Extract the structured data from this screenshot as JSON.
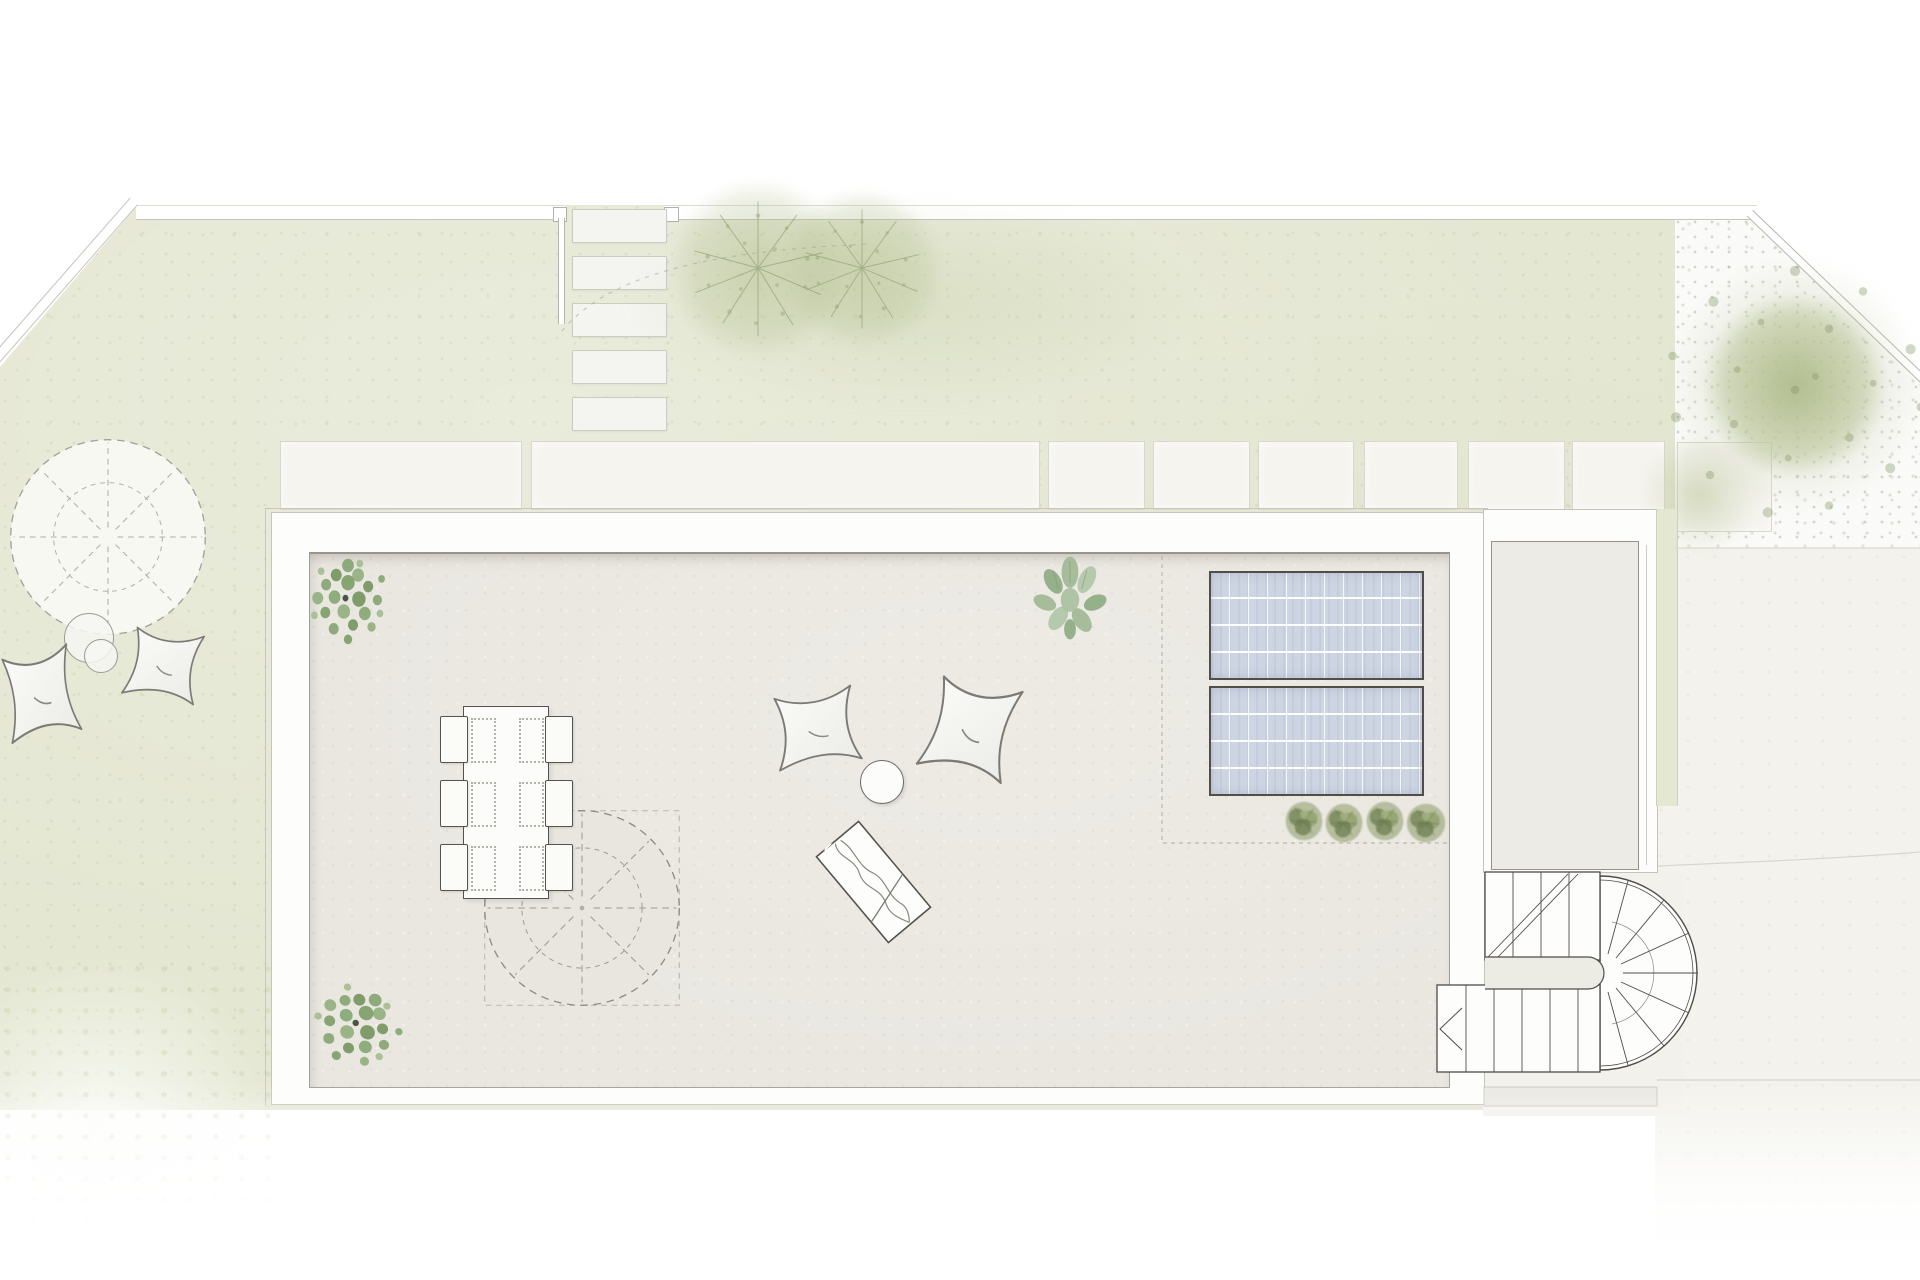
{
  "scene": {
    "title": "Roof terrace landscape plan",
    "width": 1920,
    "height": 1280
  },
  "areas": {
    "lawn": {
      "label": "garden lawn",
      "color": "#e4e7d2"
    },
    "gravel": {
      "label": "gravel bed",
      "color": "#fafaf8"
    },
    "terrace_floor": {
      "label": "roof terrace floor",
      "color": "#eae7e1"
    },
    "walkway_wall": {
      "label": "terrace parapet walkway",
      "color": "#fdfdfc"
    },
    "court": {
      "label": "lower court",
      "color": "#f3f2ec"
    }
  },
  "elements": {
    "stepping_stones": {
      "w": 93,
      "h": 32,
      "items": [
        {
          "x": 572,
          "y": 209
        },
        {
          "x": 572,
          "y": 256
        },
        {
          "x": 572,
          "y": 303
        },
        {
          "x": 572,
          "y": 350
        },
        {
          "x": 572,
          "y": 397
        }
      ]
    },
    "pavers": {
      "items": [
        {
          "x": 280,
          "y": 441,
          "w": 240,
          "h": 67
        },
        {
          "x": 531,
          "y": 441,
          "w": 507,
          "h": 67
        },
        {
          "x": 1048,
          "y": 441,
          "w": 95,
          "h": 67
        },
        {
          "x": 1153,
          "y": 441,
          "w": 95,
          "h": 67
        },
        {
          "x": 1258,
          "y": 441,
          "w": 94,
          "h": 67
        },
        {
          "x": 1364,
          "y": 441,
          "w": 92,
          "h": 67
        },
        {
          "x": 1468,
          "y": 441,
          "w": 95,
          "h": 67
        },
        {
          "x": 1572,
          "y": 441,
          "w": 91,
          "h": 67
        },
        {
          "x": 1677,
          "y": 442,
          "w": 93,
          "h": 88
        }
      ]
    },
    "solar_panels": {
      "cols": 11,
      "rows": 4,
      "items": [
        {
          "x": 1209,
          "y": 571,
          "w": 211,
          "h": 105
        },
        {
          "x": 1209,
          "y": 686,
          "w": 211,
          "h": 106
        }
      ]
    },
    "planter_grasses": {
      "items": [
        {
          "x": 1281,
          "y": 797,
          "w": 46,
          "h": 48
        },
        {
          "x": 1321,
          "y": 799,
          "w": 46,
          "h": 48
        },
        {
          "x": 1362,
          "y": 797,
          "w": 46,
          "h": 48
        },
        {
          "x": 1402,
          "y": 799,
          "w": 48,
          "h": 48
        }
      ]
    },
    "bushes": {
      "items": [
        {
          "x": 306,
          "y": 552,
          "w": 84,
          "h": 96,
          "rot": 0
        },
        {
          "x": 310,
          "y": 982,
          "w": 94,
          "h": 88,
          "rot": 35
        }
      ]
    },
    "sage_plant": {
      "x": 1028,
      "y": 552,
      "w": 84,
      "h": 92
    },
    "trees": {
      "starburst": [
        {
          "cx": 758,
          "cy": 268,
          "d": 240
        },
        {
          "cx": 862,
          "cy": 268,
          "d": 215
        }
      ],
      "starburst_glyph": [
        {
          "cx": 758,
          "cy": 268,
          "d": 190
        },
        {
          "cx": 862,
          "cy": 268,
          "d": 168
        }
      ],
      "wash": {
        "x": 620,
        "y": 195,
        "w": 580,
        "h": 215
      },
      "big": {
        "core": {
          "cx": 1795,
          "cy": 385,
          "d": 250
        },
        "halo": {
          "cx": 1795,
          "cy": 385,
          "d": 360
        },
        "blob": {
          "cx": 1700,
          "cy": 495,
          "d": 170
        },
        "speckles": {
          "cx": 1795,
          "cy": 390,
          "d": 340
        }
      }
    },
    "parasols": {
      "lawn": {
        "cx": 108,
        "cy": 537,
        "r": 103,
        "shadow": {
          "x": 16,
          "y": 448,
          "w": 196,
          "h": 196
        }
      },
      "terrace": {
        "cx": 582,
        "cy": 908,
        "r": 103,
        "shadow": {
          "x": 486,
          "y": 812,
          "w": 206,
          "h": 206
        }
      }
    },
    "side_tables": {
      "items": [
        {
          "cx": 88,
          "cy": 637,
          "r": 24
        },
        {
          "cx": 100,
          "cy": 655,
          "r": 16
        }
      ]
    },
    "pillows": {
      "items": [
        {
          "cx": 40,
          "cy": 692,
          "w": 82,
          "h": 105,
          "rot": -8,
          "area": "lawn"
        },
        {
          "cx": 164,
          "cy": 664,
          "w": 84,
          "h": 84,
          "rot": 12,
          "area": "lawn"
        },
        {
          "cx": 816,
          "cy": 727,
          "w": 96,
          "h": 90,
          "rot": -6,
          "area": "terrace"
        },
        {
          "cx": 971,
          "cy": 727,
          "w": 100,
          "h": 114,
          "rot": 16,
          "area": "terrace"
        }
      ]
    },
    "dining": {
      "table": {
        "x": 463,
        "y": 706,
        "w": 84,
        "h": 191
      },
      "chairs": {
        "w": 26,
        "h": 45,
        "items": [
          {
            "x": 440,
            "y": 716
          },
          {
            "x": 440,
            "y": 780
          },
          {
            "x": 440,
            "y": 844
          },
          {
            "x": 545,
            "y": 716
          },
          {
            "x": 545,
            "y": 780
          },
          {
            "x": 545,
            "y": 844
          }
        ]
      },
      "placemats": {
        "w": 21,
        "h": 41,
        "items": [
          {
            "x": 471,
            "y": 718
          },
          {
            "x": 471,
            "y": 782
          },
          {
            "x": 471,
            "y": 846
          },
          {
            "x": 519,
            "y": 718
          },
          {
            "x": 519,
            "y": 782
          },
          {
            "x": 519,
            "y": 846
          }
        ]
      }
    },
    "round_table": {
      "cx": 881,
      "cy": 781,
      "r": 21
    },
    "chaise": {
      "cx": 873,
      "cy": 882,
      "w": 57,
      "h": 114,
      "rot": -40
    },
    "stairs": {
      "center": {
        "x": 1603,
        "y": 973
      },
      "outer_radius": 97,
      "upper_flight": {
        "x": 1485,
        "y": 872,
        "w": 115,
        "h": 88,
        "treads": 4
      },
      "lower_flight": {
        "x": 1437,
        "y": 985,
        "w": 163,
        "h": 87,
        "treads": 6
      },
      "winder_treads": 7,
      "direction_arrow": true,
      "landing": {
        "x": 1484,
        "y": 1087,
        "w": 173,
        "h": 19
      }
    }
  },
  "palette": {
    "outline_dark": "#55534e",
    "outline_mid": "#a29e96",
    "outline_light": "#c6c3bb",
    "panel_blue": "#cdd4e2",
    "bush_green": "#86a873",
    "tree_soft": "#b1bd8d",
    "dash": "#8f8c85"
  }
}
